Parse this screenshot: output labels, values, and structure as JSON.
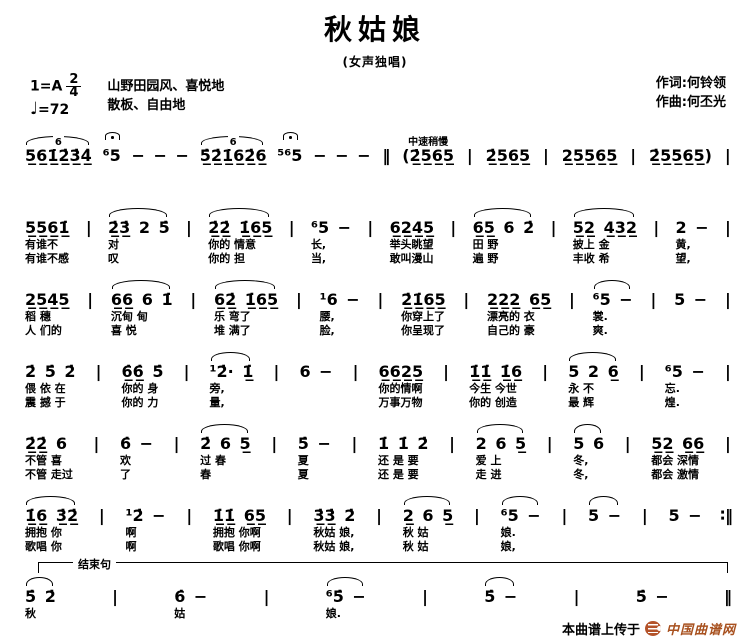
{
  "header": {
    "title": "秋姑娘",
    "subtitle": "(女声独唱)",
    "key": "1=A",
    "time_top": "2",
    "time_bottom": "4",
    "tempo_glyph": "♩",
    "tempo_value": "=72",
    "style_line1": "山野田园风、喜悦地",
    "style_line2": "散板、自由地",
    "lyricist": "作词:何铃领",
    "composer": "作曲:何丕光"
  },
  "score": {
    "systems": [
      {
        "cells": [
          {
            "n": "5̲6̲1̲̇2̲̇3̲̇4̲̇",
            "a": "6",
            "slur": true
          },
          {
            "n": "⁶5",
            "f": true
          },
          {
            "n": "− − −"
          },
          {
            "n": "5̲̇2̲̇1̲̇6̲2̲̇6̲",
            "a": "6",
            "slur": true
          },
          {
            "n": "⁵⁶5",
            "f": true
          },
          {
            "n": "− − −"
          },
          {
            "bar": true,
            "n": "‖"
          },
          {
            "n": "(2̲̇5̲6̲5̲",
            "a": "中速稍慢"
          },
          {
            "bar": true,
            "n": "|"
          },
          {
            "n": "2̲̇5̲6̲5̲"
          },
          {
            "bar": true,
            "n": "|"
          },
          {
            "n": "2̲5̲5̲6̲5̲"
          },
          {
            "bar": true,
            "n": "|"
          },
          {
            "n": "2̲̇5̲5̲6̲5̲)"
          },
          {
            "bar": true,
            "n": "|"
          }
        ]
      },
      {
        "cells": [
          {
            "n": "5̲5̲6̲1̲̇",
            "l1": "有谁不",
            "l2": "有谁不感"
          },
          {
            "bar": true,
            "n": "|"
          },
          {
            "n": "2̲̇3̲̇ 2 5̇",
            "slur": true,
            "l1": "对",
            "l2": "叹"
          },
          {
            "bar": true,
            "n": "|"
          },
          {
            "n": "2̲̇2̲̇ 1̲̇6̲5̲",
            "slur": true,
            "l1": "你的 情意",
            "l2": "你的 担"
          },
          {
            "bar": true,
            "n": "|"
          },
          {
            "n": "⁶5 −",
            "l1": "长,",
            "l2": "当,"
          },
          {
            "bar": true,
            "n": "|"
          },
          {
            "n": "6̲2̲4̲5̲",
            "l1": "举头眺望",
            "l2": "敢叫漫山"
          },
          {
            "bar": true,
            "n": "|"
          },
          {
            "n": "6̲5̲ 6 2̇",
            "slur": true,
            "l1": "田 野",
            "l2": "遍 野"
          },
          {
            "bar": true,
            "n": "|"
          },
          {
            "n": "5̲2̲ 4̲3̲2̲",
            "slur": true,
            "l1": "披上 金",
            "l2": "丰收 希"
          },
          {
            "bar": true,
            "n": "|"
          },
          {
            "n": "2 −",
            "l1": "黄,",
            "l2": "望,"
          },
          {
            "bar": true,
            "n": "|"
          }
        ]
      },
      {
        "cells": [
          {
            "n": "2̲5̲4̲5̲",
            "l1": "稻 穗",
            "l2": "人 们的"
          },
          {
            "bar": true,
            "n": "|"
          },
          {
            "n": "6̲6̲ 6 1̇",
            "slur": true,
            "l1": "沉甸 甸",
            "l2": "喜 悦"
          },
          {
            "bar": true,
            "n": "|"
          },
          {
            "n": "6̲2̲̇ 1̲̇6̲5̲",
            "slur": true,
            "l1": "乐 弯了",
            "l2": "堆 满了"
          },
          {
            "bar": true,
            "n": "|"
          },
          {
            "n": "¹6 −",
            "l1": "腰,",
            "l2": "脸,"
          },
          {
            "bar": true,
            "n": "|"
          },
          {
            "n": "2̲̇1̲̇6̲5̲",
            "l1": "你穿上了",
            "l2": "你呈现了"
          },
          {
            "bar": true,
            "n": "|"
          },
          {
            "n": "2̲2̲2̲ 6̲5̲",
            "l1": "漂亮的 衣",
            "l2": "自己的 豪"
          },
          {
            "bar": true,
            "n": "|"
          },
          {
            "n": "⁶5 −",
            "slur": true,
            "l1": "裳.",
            "l2": "爽."
          },
          {
            "bar": true,
            "n": "|"
          },
          {
            "n": "5 −"
          },
          {
            "bar": true,
            "n": "|"
          }
        ]
      },
      {
        "cells": [
          {
            "n": "2̇ 5̇ 2̇",
            "l1": "偎 依 在",
            "l2": "震 撼 于"
          },
          {
            "bar": true,
            "n": "|"
          },
          {
            "n": "6̲̇6̲̇ 5̇",
            "l1": "你的 身",
            "l2": "你的 力"
          },
          {
            "bar": true,
            "n": "|"
          },
          {
            "n": "¹2̇· 1̲̇",
            "slur": true,
            "l1": "旁,",
            "l2": "量,"
          },
          {
            "bar": true,
            "n": "|"
          },
          {
            "n": "6 −"
          },
          {
            "bar": true,
            "n": "|"
          },
          {
            "n": "6̲6̲2̲5̲",
            "l1": "你的情啊",
            "l2": "万事万物"
          },
          {
            "bar": true,
            "n": "|"
          },
          {
            "n": "1̲̇1̲̇ 1̲̇6̲",
            "l1": "今生 今世",
            "l2": "你的 创造"
          },
          {
            "bar": true,
            "n": "|"
          },
          {
            "n": "5 2 6̲",
            "slur": true,
            "l1": "永 不",
            "l2": "最 辉"
          },
          {
            "bar": true,
            "n": "|"
          },
          {
            "n": "⁶5 −",
            "l1": "忘.",
            "l2": "煌."
          },
          {
            "bar": true,
            "n": "|"
          }
        ]
      },
      {
        "cells": [
          {
            "n": "2̲̇2̲̇ 6",
            "l1": "不管 喜",
            "l2": "不管 走过"
          },
          {
            "bar": true,
            "n": "|"
          },
          {
            "n": "6̇ −",
            "l1": "欢",
            "l2": "了"
          },
          {
            "bar": true,
            "n": "|"
          },
          {
            "n": "2̇ 6 5̲",
            "slur": true,
            "l1": "过 春",
            "l2": "春"
          },
          {
            "bar": true,
            "n": "|"
          },
          {
            "n": "5̇ −",
            "l1": "夏",
            "l2": "夏"
          },
          {
            "bar": true,
            "n": "|"
          },
          {
            "n": "1̇ 1̇ 2̇",
            "l1": "还 是 要",
            "l2": "还 是 要"
          },
          {
            "bar": true,
            "n": "|"
          },
          {
            "n": "2 6 5̲",
            "slur": true,
            "l1": "爱 上",
            "l2": "走 进"
          },
          {
            "bar": true,
            "n": "|"
          },
          {
            "n": "5 6",
            "slur": true,
            "l1": "冬,",
            "l2": "冬,"
          },
          {
            "bar": true,
            "n": "|"
          },
          {
            "n": "5̲2̲ 6̲6̲",
            "l1": "都会 深情",
            "l2": "都会 激情"
          },
          {
            "bar": true,
            "n": "|"
          }
        ]
      },
      {
        "cells": [
          {
            "n": "1̲̇6̲ 3̲̇2̲̇",
            "slur": true,
            "l1": "拥抱 你",
            "l2": "歌唱 你"
          },
          {
            "bar": true,
            "n": "|"
          },
          {
            "n": "¹2̇ −",
            "l1": "啊",
            "l2": "啊"
          },
          {
            "bar": true,
            "n": "|"
          },
          {
            "n": "1̲̇1̲̇ 6̲5̲",
            "l1": "拥抱 你啊",
            "l2": "歌唱 你啊"
          },
          {
            "bar": true,
            "n": "|"
          },
          {
            "n": "3̲̇3̲̇ 2̇",
            "l1": "秋姑 娘,",
            "l2": "秋姑 娘,"
          },
          {
            "bar": true,
            "n": "|"
          },
          {
            "n": "2̲ 6 5̲",
            "slur": true,
            "l1": "秋 姑",
            "l2": "秋 姑"
          },
          {
            "bar": true,
            "n": "|"
          },
          {
            "n": "⁶5 −",
            "slur": true,
            "l1": "娘.",
            "l2": "娘,"
          },
          {
            "bar": true,
            "n": "|"
          },
          {
            "n": "5 −",
            "slur": true
          },
          {
            "bar": true,
            "n": "|"
          },
          {
            "n": "5 −"
          },
          {
            "bar": true,
            "n": "∶‖"
          }
        ]
      },
      {
        "bracket_label": "结束句",
        "cells": [
          {
            "n": "5̇ 2̇",
            "slur": true,
            "l1": "秋"
          },
          {
            "bar": true,
            "n": "|"
          },
          {
            "n": "6̇ −",
            "l1": "姑"
          },
          {
            "bar": true,
            "n": "|"
          },
          {
            "n": "⁶5̇ −",
            "slur": true,
            "l1": "娘."
          },
          {
            "bar": true,
            "n": "|"
          },
          {
            "n": "5̇ −",
            "slur": true
          },
          {
            "bar": true,
            "n": "|"
          },
          {
            "n": "5̇ −"
          },
          {
            "bar": true,
            "n": "‖"
          }
        ]
      }
    ]
  },
  "footer": {
    "upload_text": "本曲谱上传于",
    "site_name": "中国曲谱网",
    "accent_color": "#a8511f",
    "logo_color": "#b4532a"
  }
}
